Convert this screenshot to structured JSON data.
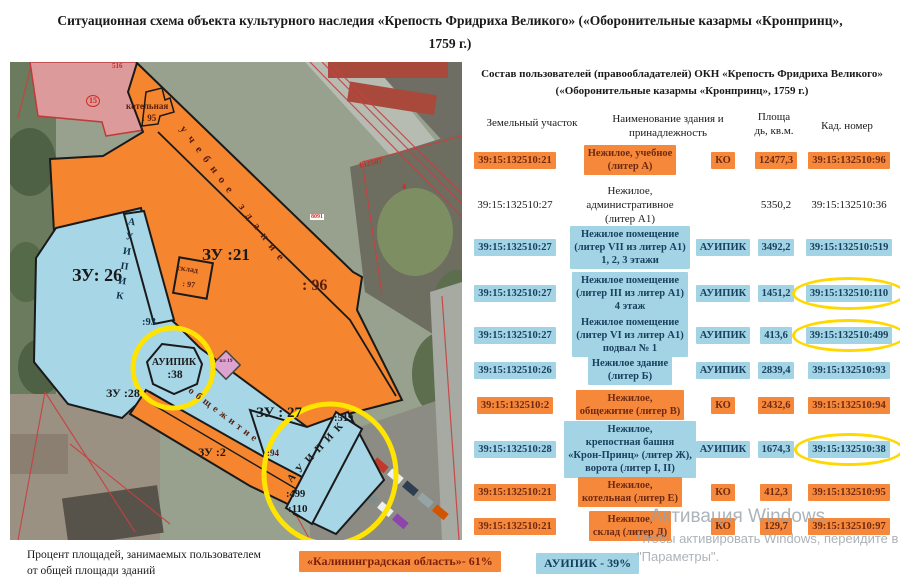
{
  "title": "Ситуационная схема объекта культурного наследия «Крепость Фридриха Великого» («Оборонительные казармы «Кронпринц», 1759 г.)",
  "map": {
    "parcel_labels": {
      "zu26": "ЗУ: 26",
      "zu21": "ЗУ :21",
      "zu27": "ЗУ : 27",
      "zu28": "ЗУ :28",
      "zu2": "ЗУ :2",
      "b96": ": 96",
      "b95": ": 95",
      "b97": ": 97",
      "b93": ":93",
      "b38": ":38",
      "b94": ":94",
      "b519": ":519",
      "b499": ":499",
      "b110": ":110",
      "kotelnaya": "котельная",
      "sklad": "склад",
      "uchebnoe": "учебное здание",
      "obshezhitie": "общежитие",
      "auipik_strip_26": "АУИПИК",
      "auipik_hex": "АУИПИК",
      "auipik_strip_27": "АУИПИК",
      "red_15": "15",
      "red_516": "516",
      "red_132507": "132507",
      "red_4": "4",
      "red_8091": "8091",
      "diamond": "пл 19"
    },
    "note": "Процент площадей, занимаемых пользователем\nот общей площади  зданий"
  },
  "table": {
    "title": "Состав пользователей (правообладателей) ОКН «Крепость Фридриха  Великого»\n(«Оборонительные казармы «Кронпринц», 1759 г.)",
    "columns": {
      "land_parcel": "Земельный участок",
      "building_name": "Наименование  здания  и\nпринадлежность",
      "area": "Площа\nдь, кв.м.",
      "cad_number": "Кад. номер"
    },
    "rows": [
      {
        "theme": "orange",
        "parcel": "39:15:132510:21",
        "name": "Нежилое, учебное\n(литер А)",
        "user": "КО",
        "area": "12477,3",
        "cad": "39:15:132510:96",
        "circled": false
      },
      {
        "theme": "plain",
        "parcel": "39:15:132510:27",
        "name": "Нежилое, административное\n(литер А1)",
        "user": "",
        "area": "5350,2",
        "cad": "39:15:132510:36",
        "circled": false
      },
      {
        "theme": "blue",
        "parcel": "39:15:132510:27",
        "name": "Нежилое помещение\n(литер VII из литер А1)\n1, 2, 3 этажи",
        "user": "АУИПИК",
        "area": "3492,2",
        "cad": "39:15:132510:519",
        "circled": false
      },
      {
        "theme": "blue",
        "parcel": "39:15:132510:27",
        "name": "Нежилое помещение\n(литер III из литер А1)\n4 этаж",
        "user": "АУИПИК",
        "area": "1451,2",
        "cad": "39:15:132510:110",
        "circled": true
      },
      {
        "theme": "blue",
        "parcel": "39:15:132510:27",
        "name": "Нежилое помещение\n(литер VI из литер А1)\nподвал № 1",
        "user": "АУИПИК",
        "area": "413,6",
        "cad": "39:15:132510:499",
        "circled": true
      },
      {
        "theme": "blue",
        "parcel": "39:15:132510:26",
        "name": "Нежилое здание\n(литер Б)",
        "user": "АУИПИК",
        "area": "2839,4",
        "cad": "39:15:132510:93",
        "circled": false
      },
      {
        "theme": "orange",
        "parcel": "39:15:132510:2",
        "name": "Нежилое,\nобщежитие  (литер В)",
        "user": "КО",
        "area": "2432,6",
        "cad": "39:15:132510:94",
        "circled": false
      },
      {
        "theme": "blue",
        "parcel": "39:15:132510:28",
        "name": "Нежилое,\nкрепостная  башня\n«Крон-Принц»  (литер Ж),\nворота (литер I, II)",
        "user": "АУИПИК",
        "area": "1674,3",
        "cad": "39:15:132510:38",
        "circled": true
      },
      {
        "theme": "orange",
        "parcel": "39:15:132510:21",
        "name": "Нежилое,\nкотельная  (литер Е)",
        "user": "КО",
        "area": "412,3",
        "cad": "39:15:132510:95",
        "circled": false
      },
      {
        "theme": "orange",
        "parcel": "39:15:132510:21",
        "name": "Нежилое,\nсклад  (литер Д)",
        "user": "КО",
        "area": "129,7",
        "cad": "39:15:132510:97",
        "circled": false
      }
    ]
  },
  "legend": {
    "ko": "«Калининградская  область»- 61%",
    "auipik": "АУИПИК  - 39%"
  },
  "watermark": {
    "line1": "Активация Windows",
    "line2": "Чтобы активировать Windows, перейдите в раздел",
    "line3": "\"Параметры\"."
  },
  "colors": {
    "orange_parcel": "#f5862f",
    "blue_parcel": "#a7d6e7",
    "orange_chip": "#f6883b",
    "blue_chip": "#a3d4e6",
    "pink_building": "#dd9a9a",
    "yellow_annotation": "#ffe400",
    "red_cadastral_line": "#c94040"
  }
}
